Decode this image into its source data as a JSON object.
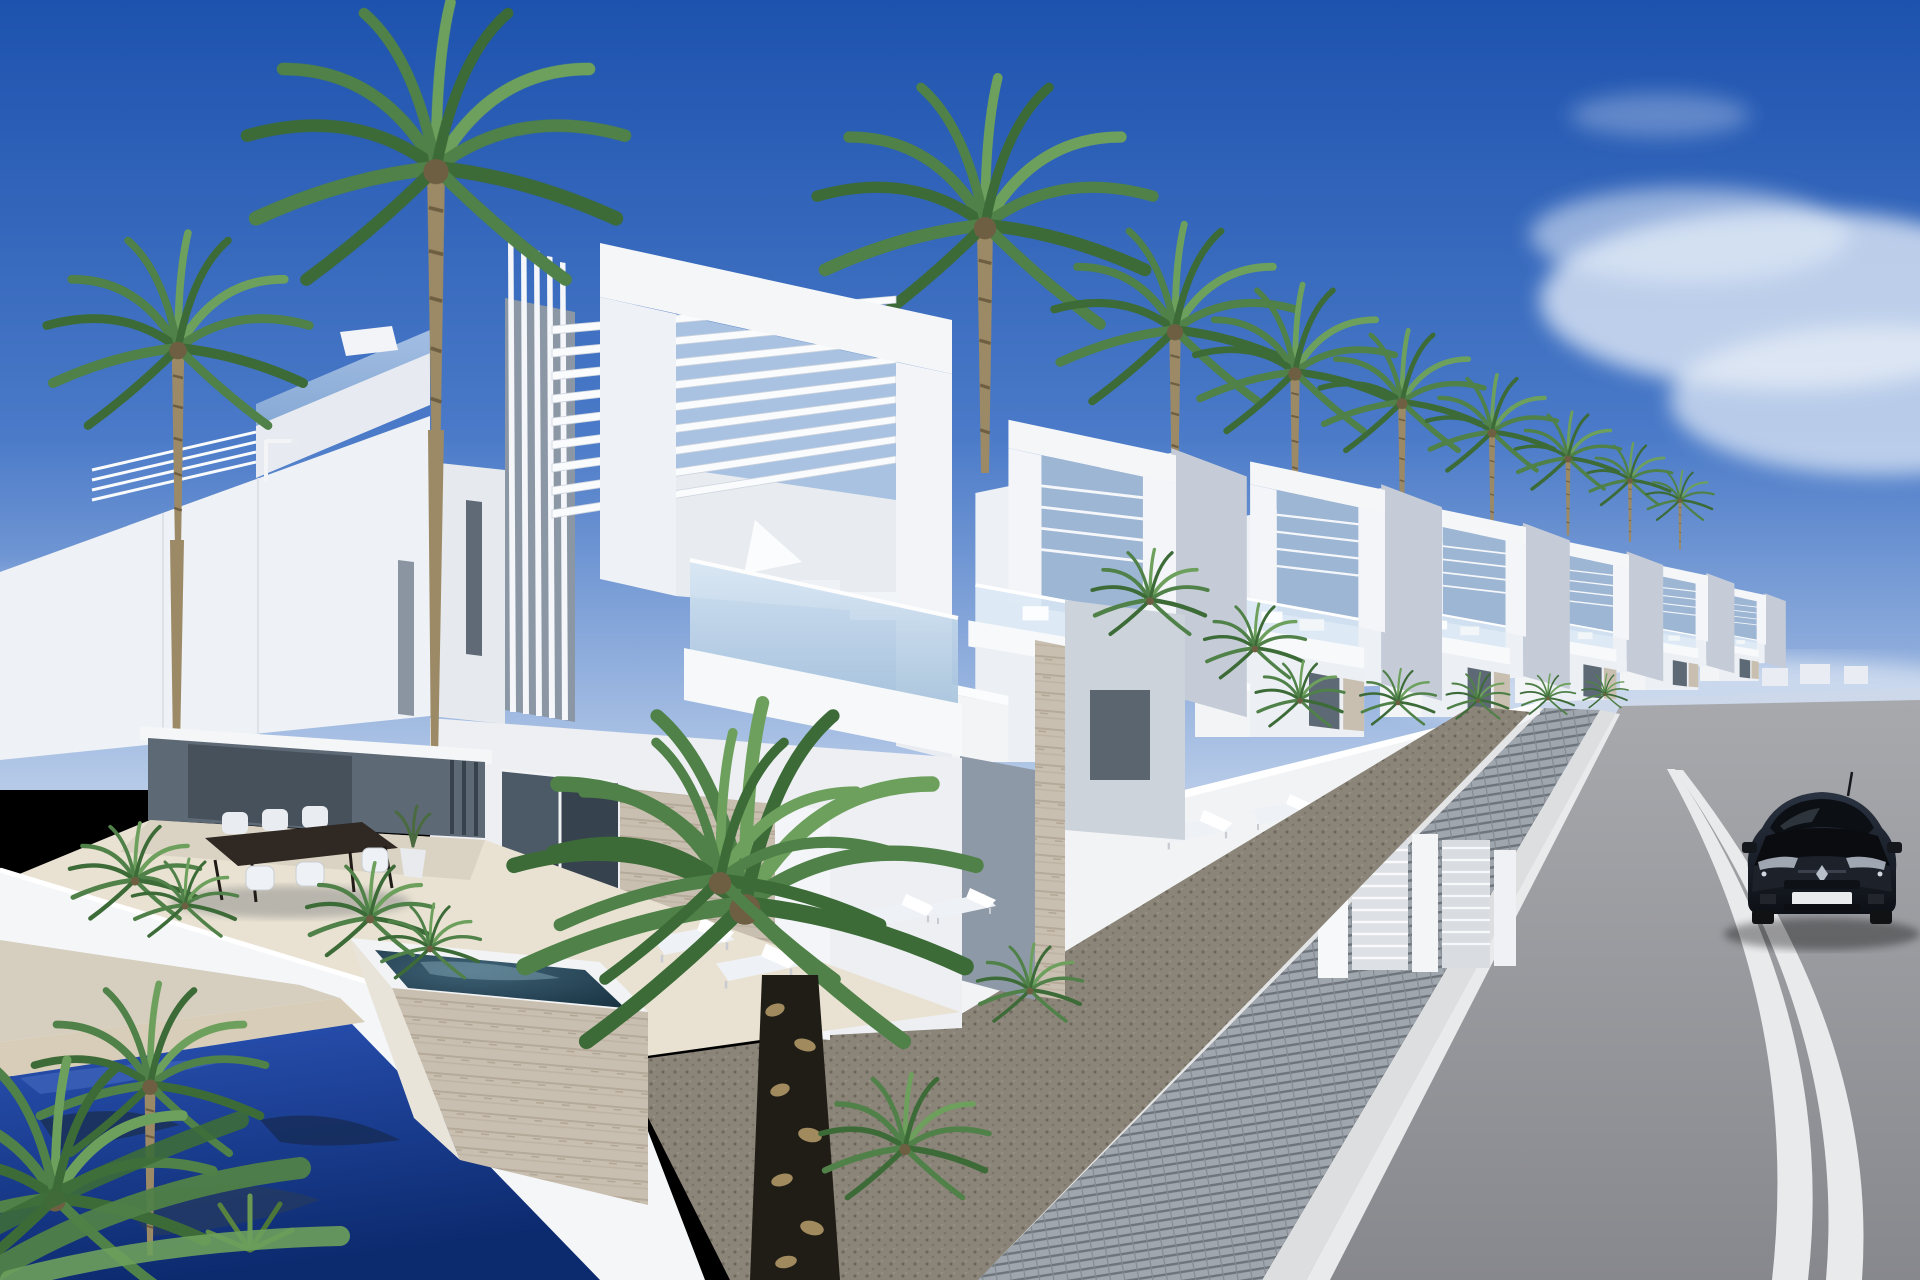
{
  "scene": {
    "type": "architectural-render",
    "description": "Row of modern white two-storey villas with rooftop pergolas, vertical louvers and glass balconies along a sunny street lined with palm trees; foreground terrace with dining set, raised plunge spa and blue swimming pool; dark hatchback car on the asphalt road at right",
    "objects": [
      "sky",
      "clouds",
      "palm-trees",
      "white-villas",
      "pergola-slats",
      "glass-balcony",
      "dining-set",
      "sun-loungers",
      "plunge-spa",
      "swimming-pool",
      "garden-walls",
      "slatted-gates",
      "gravel-bed",
      "paver-sidewalk",
      "asphalt-road",
      "road-markings",
      "black-hatchback-car",
      "street-lamp"
    ]
  },
  "colors": {
    "sky_top": "#1d52ae",
    "sky_mid": "#4a7ac8",
    "sky_horizon": "#b7cbe8",
    "cloud": "#e8eff8",
    "wall_sun": "#f4f6f8",
    "wall_lit": "#edf0f5",
    "wall_shade": "#c5ccd7",
    "recess": "#5d6975",
    "garage": "#46515c",
    "glass_hi": "#d9e7f5",
    "glass_lo": "#a7c3dc",
    "stone": "#c9bfb0",
    "stone_line": "#b5a999",
    "deck": "#e9e2d2",
    "deck_shade": "#d6cfbf",
    "gravel": "#8b8478",
    "paver": "#a0a6ae",
    "paver_joint": "#6e747c",
    "curb": "#dcdee0",
    "asphalt_far": "#a8a9ad",
    "asphalt_near": "#87888d",
    "road_line": "#e9eaec",
    "pool_top": "#2a52b4",
    "pool_deep": "#0c2a6e",
    "spa_hi": "#3f6276",
    "spa_lo": "#16303f",
    "palm_dark": "#3c6b38",
    "palm_mid": "#4f8148",
    "palm_light": "#6da05c",
    "trunk": "#9c8a66",
    "trunk_dark": "#6e5f43",
    "black_trunk": "#201d17",
    "black_trunk_tan": "#a08a5e",
    "car_top": "#2a3342",
    "car_bottom": "#0d1016",
    "car_glass": "#0c0f13",
    "car_light": "#aeb6c2",
    "plate": "#e9ebed",
    "shadow": "#3a4250",
    "table_wood": "#2f2823",
    "furniture_white": "#eef2f6"
  }
}
